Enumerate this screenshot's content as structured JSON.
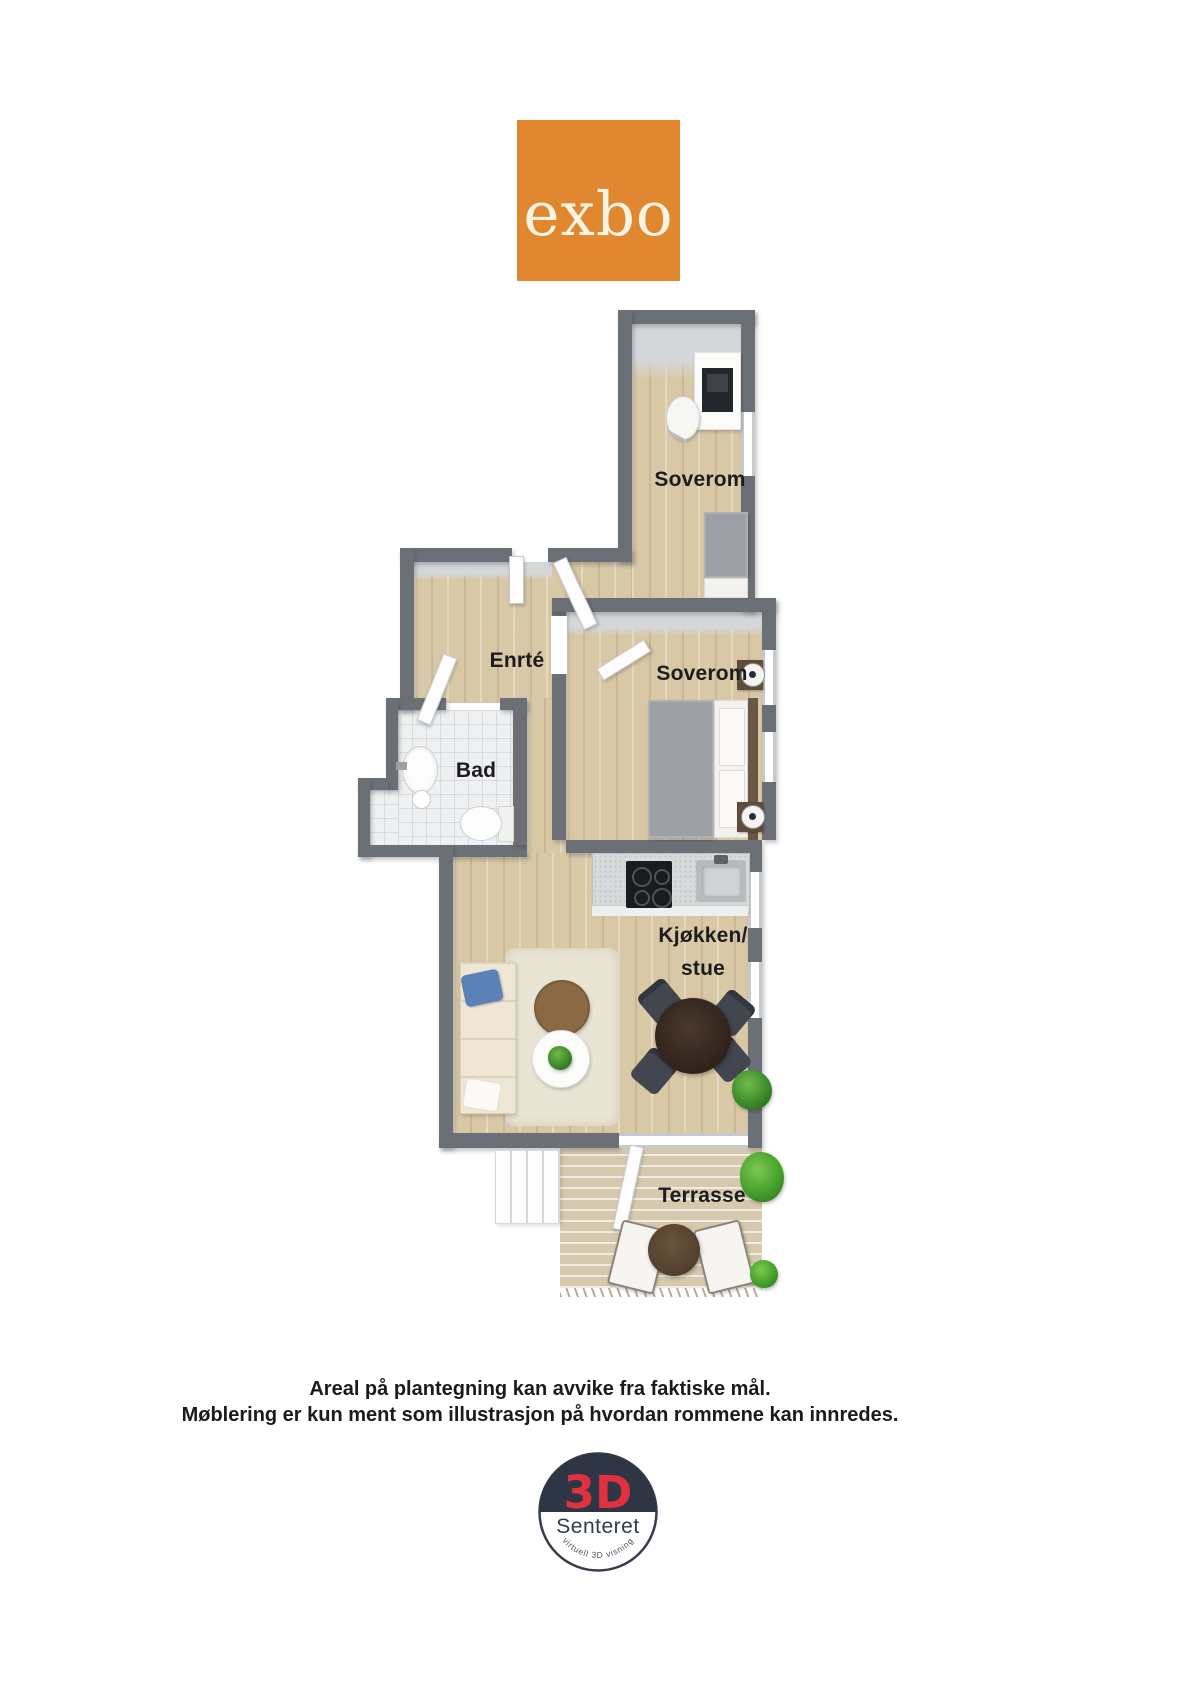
{
  "brand": {
    "name": "exbo",
    "logo_bg": "#e0872f",
    "logo_text_color": "#faf4e4"
  },
  "plan": {
    "labels": {
      "bedroom1": "Soverom",
      "entrance": "Enrté",
      "bathroom": "Bad",
      "bedroom2": "Soverom",
      "kitchen_line1": "Kjøkken/",
      "kitchen_line2": "stue",
      "terrace": "Terrasse"
    },
    "colors": {
      "wall": "#6b7077",
      "wood_floor": "#d9c8a6",
      "bath_tile": "#eef0f1",
      "terrace_deck": "#d6c9ad"
    }
  },
  "disclaimer": {
    "line1": "Areal på plantegning kan avvike fra faktiske mål.",
    "line2": "Møblering er kun ment som illustrasjon på hvordan rommene kan innredes."
  },
  "footer_logo": {
    "top": "3D",
    "bottom": "Senteret",
    "tagline": "virtuell 3D visning",
    "accent": "#e0313f",
    "navy": "#2e3544"
  }
}
